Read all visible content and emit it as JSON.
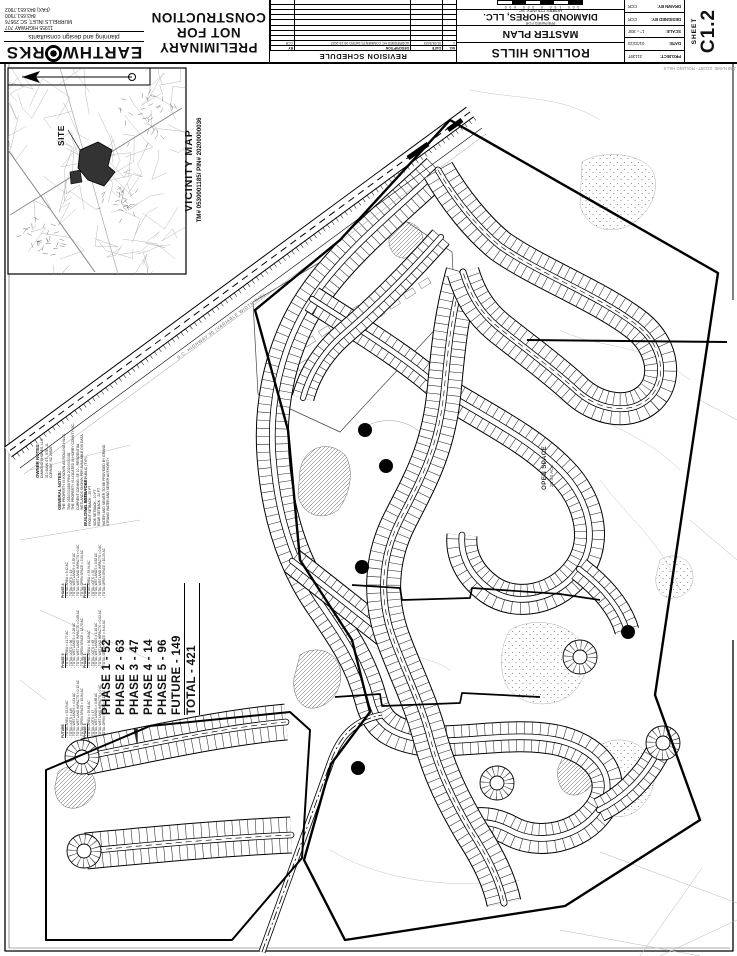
{
  "title_block": {
    "firm": {
      "name_left": "EARTHW",
      "name_right": "RKS",
      "gear_icon": "gear-globe-logo",
      "tagline": "planning and design consultants",
      "address_line1": "11955 HIGHWAY 707",
      "address_line2": "MURRELLS INLET, SC 29576",
      "phone": "843.651.7900",
      "fax": "(FAX) 843.651.7902"
    },
    "preliminary": {
      "line1": "PRELIMINARY",
      "line2": "NOT FOR",
      "line3": "CONSTRUCTION"
    },
    "revision_schedule": {
      "caption": "REVISION SCHEDULE",
      "headers": [
        "NO.",
        "DATE",
        "DESCRIPTION",
        "BY"
      ],
      "rows": [
        {
          "no": "1",
          "date": "01/31/2023",
          "description": "ADDRESSED HC COMMENTS DATED 09-19-2022",
          "by": "CCR"
        }
      ],
      "empty_row_count": 9
    },
    "project": {
      "name": "ROLLING HILLS",
      "sheet_title": "MASTER PLAN",
      "prepared_for": "PREPARED FOR",
      "client": "DIAMOND SHORES, LLC.",
      "location": "HORRY COUNTY, SC",
      "scale_bar_labels": "300   150   0   300   600"
    },
    "info": {
      "project_label": "PROJECT:",
      "project": "21139T",
      "date_label": "DATE:",
      "date": "01/31/23",
      "scale_label": "SCALE:",
      "scale": "1\" = 300'",
      "designed_label": "DESIGNED BY:",
      "designed": "CCR",
      "drawn_label": "DRAWN BY:",
      "drawn": "CCR"
    },
    "sheet": {
      "label": "SHEET",
      "number": "C1.2"
    }
  },
  "vicinity": {
    "title": "VICINITY MAP",
    "subtitle": "TM# 0530001185/ PIN# 20200000036",
    "site_label": "SITE",
    "north_arrow_icon": "north-arrow-icon"
  },
  "notes": {
    "owner": {
      "heading": "OWNER NOTES:",
      "lines": [
        "DIAMOND SHORES, LLC",
        "310 MAIN ST., STE. 11",
        "CONWAY, SC 29526"
      ]
    },
    "general": {
      "heading": "GENERAL NOTES:",
      "lines": [
        "THE PROPERTY IS KNOWN AS ROLLING HILLS.",
        "TM# 0530001185/ PIN# 20200000036",
        "THE PROPERTY IS LOCATED IN HORRY COUNTY, SC.",
        "CURRENT ZONING: SF 10 - RESIDENTIAL",
        "WETLANDS SHOWN PER AVAILABLE GIS DATA.",
        "ALL ROADS TO BE PUBLIC (TYP.)."
      ]
    },
    "setbacks": {
      "heading": "BUILDING SETBACKS:",
      "lines": [
        "FRONT SETBACK - 25 FT",
        "SIDE SETBACK - 10 FT",
        "REAR SETBACK - 20 FT",
        "WATER AND SEWER TO BE PROVIDED BY GRAND",
        "STRAND WATER AND SEWER AUTHORITY"
      ]
    }
  },
  "phase_summary": {
    "lines": [
      "PHASE 1 - 52",
      "PHASE 2 - 63",
      "PHASE 3 - 47",
      "PHASE 4 - 14",
      "PHASE 5 - 96",
      "FUTURE - 149",
      "TOTAL  - 421"
    ],
    "underline_from_index": 5
  },
  "phase_details": [
    {
      "heading": "PHASE 1",
      "lines": [
        "TOTAL AREA = 33.94 AC",
        "TOTAL LOTS = 52",
        "TOTAL WETLANDS = 0.62 AC",
        "TOTAL WETLAND IMPACTS = 0 AC",
        "TOTAL OPEN SPACE = 10.25 AC"
      ]
    },
    {
      "heading": "PHASE 2",
      "lines": [
        "TOTAL AREA = 30.18 AC",
        "TOTAL LOTS = 63",
        "TOTAL WETLANDS = 1.10 AC",
        "TOTAL WETLAND IMPACTS = 0.02 AC",
        "TOTAL OPEN SPACE = 8.44 AC"
      ]
    },
    {
      "heading": "PHASE 3",
      "lines": [
        "TOTAL AREA = 25.61 AC",
        "TOTAL LOTS = 47",
        "TOTAL WETLANDS = 0.88 AC",
        "TOTAL WETLAND IMPACTS = 0 AC",
        "TOTAL OPEN SPACE = 7.12 AC"
      ]
    },
    {
      "heading": "PHASE 4",
      "lines": [
        "TOTAL AREA = 9.42 AC",
        "TOTAL LOTS = 14",
        "TOTAL WETLANDS = 0.35 AC",
        "TOTAL WETLAND IMPACTS = 0 AC",
        "TOTAL OPEN SPACE = 2.91 AC"
      ]
    },
    {
      "heading": "PHASE 5",
      "lines": [
        "TOTAL AREA = 41.77 AC",
        "TOTAL LOTS = 96",
        "TOTAL WETLANDS = 2.26 AC",
        "TOTAL WETLAND IMPACTS = 0.08 AC",
        "TOTAL OPEN SPACE = 12.70 AC"
      ]
    },
    {
      "heading": "FUTURE",
      "lines": [
        "TOTAL AREA = 52.13 AC",
        "TOTAL LOTS = 149",
        "TOTAL WETLANDS = 4.41 AC",
        "TOTAL WETLAND IMPACTS = 0.12 AC",
        "TOTAL OPEN SPACE = 15.84 AC"
      ]
    }
  ],
  "plan": {
    "open_space_label": "OPEN SPACE",
    "open_space_acreage": "20.03 AC±",
    "highway_label": "S.C. HIGHWAY 90 (VARIABLE WIDTH R/W)",
    "job_note": "JOB NAME: 21139T - ROLLING HILLS"
  },
  "colors": {
    "ink": "#111111",
    "faint": "#999999",
    "paper": "#ffffff"
  }
}
